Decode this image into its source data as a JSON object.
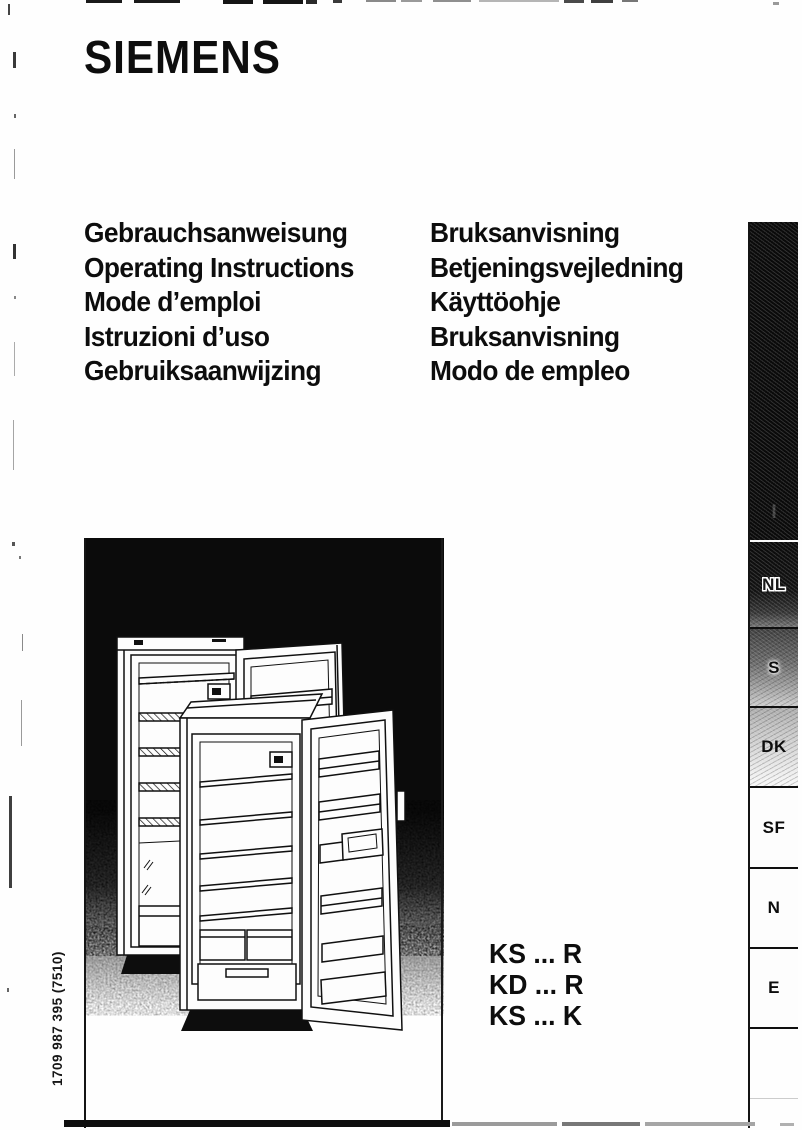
{
  "brand": "SIEMENS",
  "titles": {
    "left": [
      "Gebrauchsanweisung",
      "Operating Instructions",
      "Mode d’emploi",
      "Istruzioni d’uso",
      "Gebruiksaanwijzing"
    ],
    "right": [
      "Bruksanvisning",
      "Betjeningsvejledning",
      "Käyttöohje",
      "Bruksanvisning",
      "Modo de empleo"
    ]
  },
  "models": {
    "lines": [
      "KS ... R",
      "KD ... R",
      "KS ... K"
    ]
  },
  "sidebar": {
    "black_block_faint_label": "I",
    "tabs": [
      {
        "label": "NL"
      },
      {
        "label": "S"
      },
      {
        "label": "DK"
      },
      {
        "label": "SF"
      },
      {
        "label": "N"
      },
      {
        "label": "E"
      }
    ]
  },
  "footer": {
    "order_number": "1709 987 395 (7510)"
  },
  "illustration": {
    "description": "Black panel with line drawing of two upright refrigerators with open doors and interior shelves"
  },
  "colors": {
    "ink": "#111111",
    "paper": "#fefefe",
    "panel_black": "#0b0b0b"
  }
}
